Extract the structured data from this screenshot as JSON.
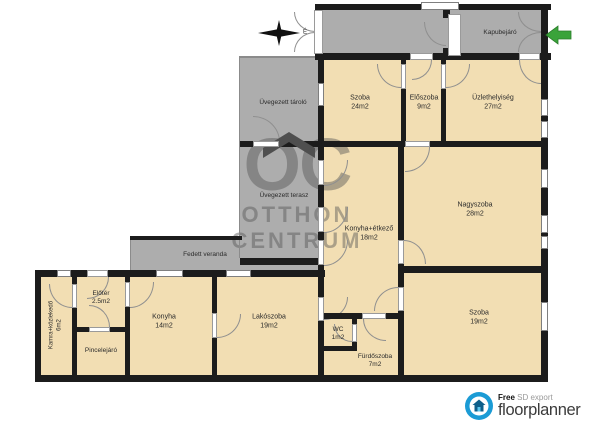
{
  "colors": {
    "floor_tan": "#F2DEB3",
    "area_gray": "#ADADAD",
    "wall_dark": "#1C1C1C",
    "arrow_green": "#3AA33A",
    "brand_blue": "#1B9BD5"
  },
  "compass": {
    "letter": "É"
  },
  "watermark": {
    "line1": "OC",
    "line2": "OTTHON",
    "line3": "CENTRUM"
  },
  "rooms": {
    "kapubejaro": {
      "name": "Kapubejáró"
    },
    "uvegezett_tarolo": {
      "name": "Üvegezett tároló"
    },
    "szoba_felso": {
      "name": "Szoba",
      "area": "24m2"
    },
    "eloszoba": {
      "name": "Előszoba",
      "area": "9m2"
    },
    "uzlethelyiseg": {
      "name": "Üzlethelyiség",
      "area": "27m2"
    },
    "uvegezett_terasz": {
      "name": "Üvegezett terasz"
    },
    "konyha_etkezo": {
      "name": "Konyha+étkező",
      "area": "18m2"
    },
    "nagyszoba": {
      "name": "Nagyszoba",
      "area": "28m2"
    },
    "fedett_veranda": {
      "name": "Fedett veranda"
    },
    "kamra": {
      "name": "Kamra+közlekedő",
      "area": "6m2"
    },
    "eloter": {
      "name": "Előtér",
      "area": "2.5m2"
    },
    "pincelejaro": {
      "name": "Pincelejáró"
    },
    "konyha": {
      "name": "Konyha",
      "area": "14m2"
    },
    "lakoszoba": {
      "name": "Lakószoba",
      "area": "19m2"
    },
    "wc": {
      "name": "WC",
      "area": "1m2"
    },
    "furdoszoba": {
      "name": "Fürdőszoba",
      "area": "7m2"
    },
    "szoba_also": {
      "name": "Szoba",
      "area": "19m2"
    }
  },
  "footer": {
    "free": "Free",
    "export_label": "SD export",
    "brand": "floorplanner"
  }
}
